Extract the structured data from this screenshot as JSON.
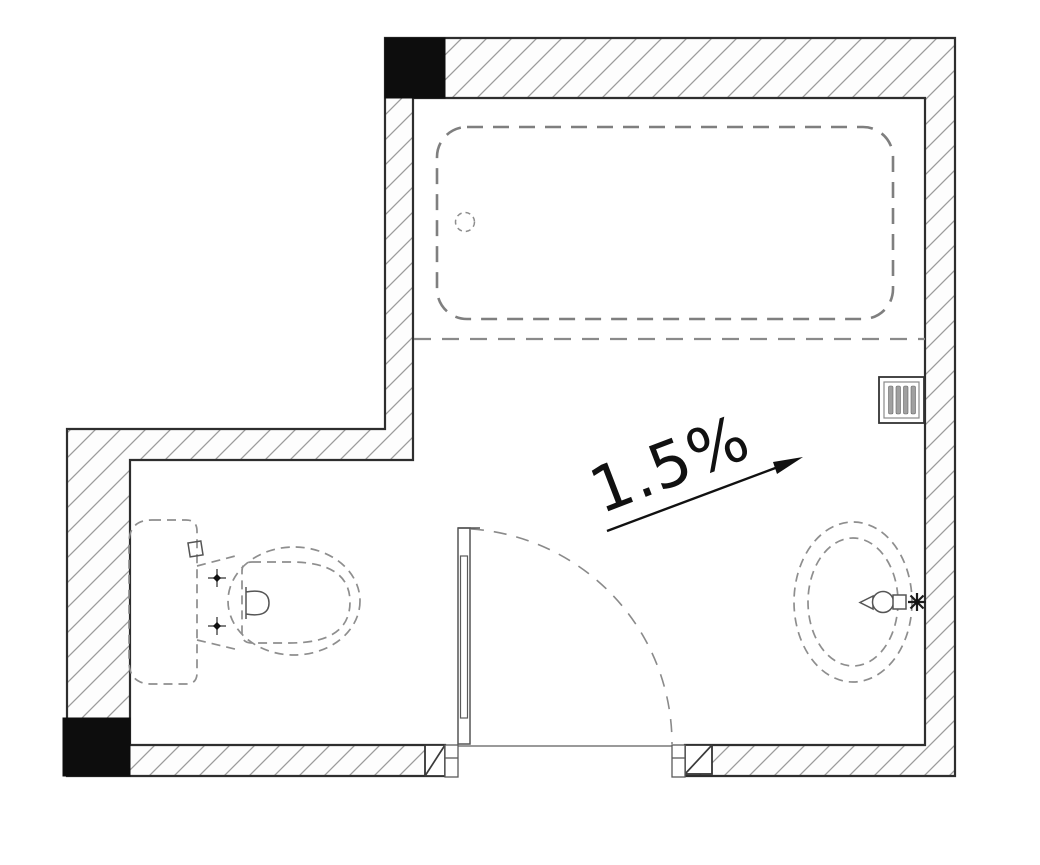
{
  "annotation": {
    "slope_label": "1.5%"
  },
  "plan": {
    "type": "bathroom-floor-plan",
    "symbols": [
      "bathtub-symbol",
      "bathtub-drain-symbol",
      "shower-screen-edge-symbol",
      "toilet-symbol",
      "toilet-cistern-symbol",
      "wash-basin-symbol",
      "faucet-symbol",
      "door-leaf-symbol",
      "door-swing-arc-symbol",
      "vent-grille-symbol",
      "structural-column-symbol",
      "structural-column-symbol",
      "wall-hatch-pattern",
      "floor-slope-arrow-symbol"
    ],
    "colors": {
      "background": "#ffffff",
      "wall_line": "#2e2e2e",
      "wall_hatch": "#9c9c9c",
      "fixture_dash": "#8e8e8e",
      "bathtub_dash": "#7f7f7f",
      "column_fill": "#0d0d0d",
      "annotation_ink": "#111111"
    }
  }
}
